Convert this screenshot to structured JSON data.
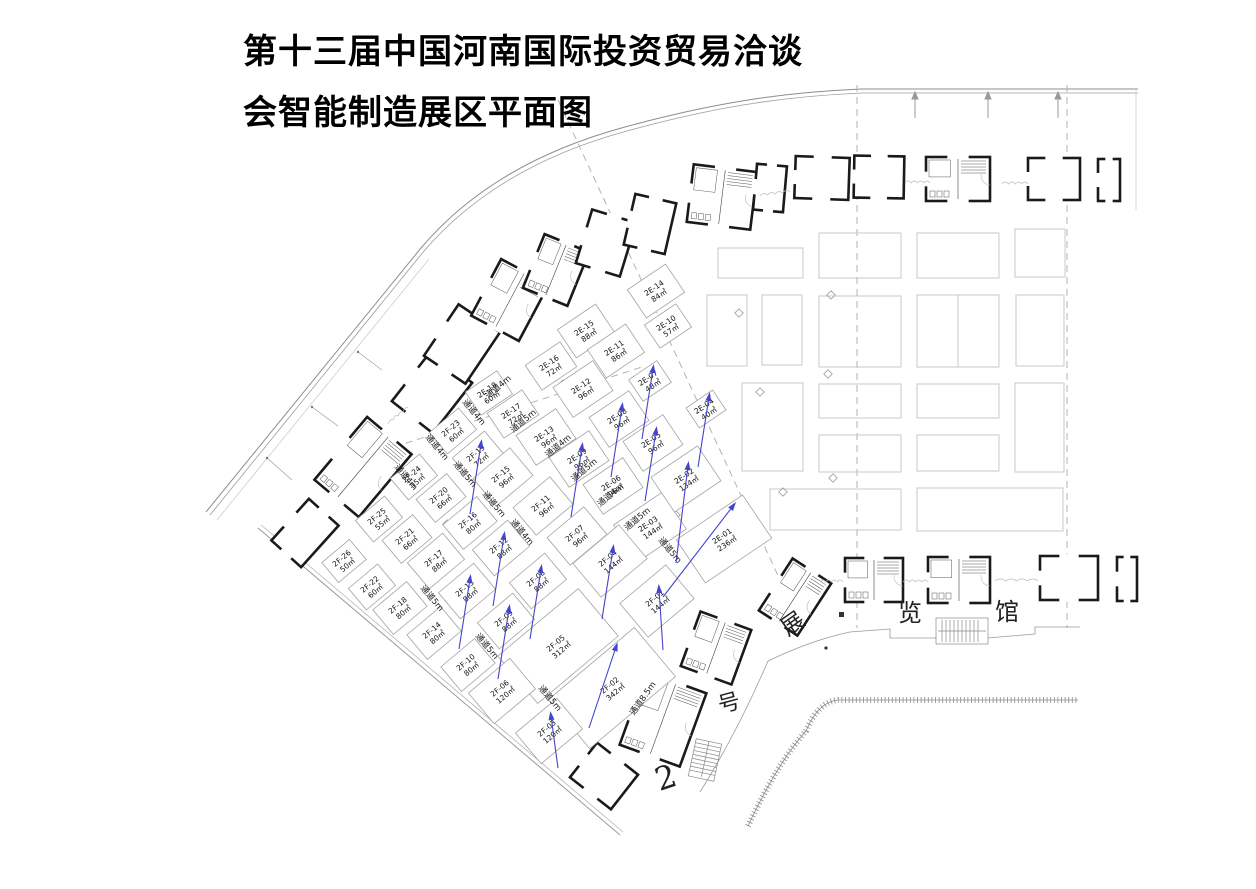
{
  "title": {
    "line1": "第十三届中国河南国际投资贸易洽谈",
    "line2": "会智能制造展区平面图"
  },
  "hall_text": [
    {
      "name": "hall-char-zhan",
      "ch": "展",
      "x": 797,
      "y": 630,
      "rot": -35,
      "size": 23
    },
    {
      "name": "hall-char-lan",
      "ch": "览",
      "x": 910,
      "y": 621,
      "rot": 0,
      "size": 24
    },
    {
      "name": "hall-char-guan",
      "ch": "馆",
      "x": 1007,
      "y": 620,
      "rot": 0,
      "size": 24
    },
    {
      "name": "hall-char-hao",
      "ch": "号",
      "x": 731,
      "y": 710,
      "rot": -15,
      "size": 22
    },
    {
      "name": "hall-number",
      "ch": "2",
      "x": 669,
      "y": 788,
      "rot": -18,
      "size": 32
    }
  ],
  "colors": {
    "arrow_blue": "#4444cc",
    "booth_outline": "#a3a3a3",
    "wall_black": "#1a1a1a",
    "gray_booth": "#c2c2c2",
    "dashed_line": "#b3b3b3"
  },
  "aisles": [
    {
      "label": "通道4m",
      "x": 500,
      "y": 389,
      "rot": -40
    },
    {
      "label": "通道5m",
      "x": 525,
      "y": 423,
      "rot": -40
    },
    {
      "label": "通道4m",
      "x": 560,
      "y": 448,
      "rot": -40
    },
    {
      "label": "通道5m",
      "x": 586,
      "y": 472,
      "rot": -40
    },
    {
      "label": "通道4m",
      "x": 612,
      "y": 497,
      "rot": -40
    },
    {
      "label": "通道5m",
      "x": 639,
      "y": 521,
      "rot": -40
    },
    {
      "label": "通道4m",
      "x": 472,
      "y": 414,
      "rot": 50
    },
    {
      "label": "通道4m",
      "x": 435,
      "y": 449,
      "rot": 50
    },
    {
      "label": "通道4m",
      "x": 404,
      "y": 479,
      "rot": 50
    },
    {
      "label": "通道5m",
      "x": 463,
      "y": 476,
      "rot": 50
    },
    {
      "label": "通道5m",
      "x": 492,
      "y": 506,
      "rot": 50
    },
    {
      "label": "通道4m",
      "x": 520,
      "y": 534,
      "rot": 50
    },
    {
      "label": "通道5m",
      "x": 430,
      "y": 600,
      "rot": 50
    },
    {
      "label": "通道5m",
      "x": 485,
      "y": 648,
      "rot": 50
    },
    {
      "label": "通道5m",
      "x": 548,
      "y": 700,
      "rot": 50
    },
    {
      "label": "通道5m",
      "x": 668,
      "y": 552,
      "rot": 50
    },
    {
      "label": "通道8.5m",
      "x": 645,
      "y": 700,
      "rot": -55
    }
  ],
  "booths": [
    {
      "id": "2E-18",
      "area": "60㎡",
      "cx": 489,
      "cy": 393,
      "w": 38,
      "h": 28,
      "rot": -34,
      "arrow": false
    },
    {
      "id": "2E-17",
      "area": "72㎡",
      "cx": 513,
      "cy": 414,
      "w": 42,
      "h": 30,
      "rot": -34,
      "arrow": false
    },
    {
      "id": "2E-16",
      "area": "72㎡",
      "cx": 551,
      "cy": 366,
      "w": 42,
      "h": 30,
      "rot": -34,
      "arrow": false
    },
    {
      "id": "2E-15",
      "area": "88㎡",
      "cx": 586,
      "cy": 331,
      "w": 46,
      "h": 34,
      "rot": -34,
      "arrow": false
    },
    {
      "id": "2E-14",
      "area": "84㎡",
      "cx": 656,
      "cy": 291,
      "w": 46,
      "h": 34,
      "rot": -34,
      "arrow": false
    },
    {
      "id": "2E-13",
      "area": "96㎡",
      "cx": 546,
      "cy": 437,
      "w": 48,
      "h": 36,
      "rot": -34,
      "arrow": false
    },
    {
      "id": "2E-12",
      "area": "96㎡",
      "cx": 583,
      "cy": 389,
      "w": 48,
      "h": 36,
      "rot": -34,
      "arrow": false
    },
    {
      "id": "2E-11",
      "area": "86㎡",
      "cx": 616,
      "cy": 351,
      "w": 46,
      "h": 34,
      "rot": -34,
      "arrow": false
    },
    {
      "id": "2E-10",
      "area": "57㎡",
      "cx": 668,
      "cy": 326,
      "w": 38,
      "h": 28,
      "rot": -34,
      "arrow": false
    },
    {
      "id": "2E-09",
      "area": "96㎡",
      "cx": 579,
      "cy": 459,
      "w": 48,
      "h": 36,
      "rot": -34,
      "arrow": true
    },
    {
      "id": "2E-08",
      "area": "96㎡",
      "cx": 619,
      "cy": 419,
      "w": 48,
      "h": 36,
      "rot": -34,
      "arrow": true
    },
    {
      "id": "2E-07",
      "area": "48㎡",
      "cx": 650,
      "cy": 381,
      "w": 34,
      "h": 26,
      "rot": -34,
      "arrow": true
    },
    {
      "id": "2E-06",
      "area": "96㎡",
      "cx": 613,
      "cy": 486,
      "w": 48,
      "h": 36,
      "rot": -34,
      "arrow": false
    },
    {
      "id": "2E-05",
      "area": "96㎡",
      "cx": 653,
      "cy": 443,
      "w": 48,
      "h": 36,
      "rot": -34,
      "arrow": true
    },
    {
      "id": "2E-04",
      "area": "40㎡",
      "cx": 706,
      "cy": 409,
      "w": 32,
      "h": 24,
      "rot": -34,
      "arrow": true
    },
    {
      "id": "2E-03",
      "area": "144㎡",
      "cx": 650,
      "cy": 527,
      "w": 58,
      "h": 44,
      "rot": -34,
      "arrow": false
    },
    {
      "id": "2E-02",
      "area": "134㎡",
      "cx": 686,
      "cy": 479,
      "w": 56,
      "h": 42,
      "rot": -34,
      "arrow": true,
      "a": [
        688,
        466,
        676,
        563
      ]
    },
    {
      "id": "2E-01",
      "area": "236㎡",
      "cx": 724,
      "cy": 539,
      "w": 80,
      "h": 52,
      "rot": -34,
      "arrow": true,
      "a": [
        733,
        506,
        663,
        597
      ]
    },
    {
      "id": "2F-23",
      "area": "60㎡",
      "cx": 453,
      "cy": 431,
      "w": 38,
      "h": 28,
      "rot": -40,
      "arrow": false
    },
    {
      "id": "2F-19",
      "area": "72㎡",
      "cx": 478,
      "cy": 456,
      "w": 42,
      "h": 30,
      "rot": -40,
      "arrow": true
    },
    {
      "id": "2F-15",
      "area": "96㎡",
      "cx": 503,
      "cy": 477,
      "w": 48,
      "h": 36,
      "rot": -40,
      "arrow": false
    },
    {
      "id": "2F-11",
      "area": "96㎡",
      "cx": 543,
      "cy": 506,
      "w": 48,
      "h": 36,
      "rot": -40,
      "arrow": false
    },
    {
      "id": "2F-07",
      "area": "96㎡",
      "cx": 577,
      "cy": 536,
      "w": 48,
      "h": 36,
      "rot": -40,
      "arrow": false
    },
    {
      "id": "2F-24",
      "area": "55㎡",
      "cx": 414,
      "cy": 477,
      "w": 38,
      "h": 28,
      "rot": -40,
      "arrow": false
    },
    {
      "id": "2F-20",
      "area": "66㎡",
      "cx": 441,
      "cy": 498,
      "w": 40,
      "h": 30,
      "rot": -40,
      "arrow": false
    },
    {
      "id": "2F-16",
      "area": "80㎡",
      "cx": 470,
      "cy": 523,
      "w": 44,
      "h": 32,
      "rot": -40,
      "arrow": false
    },
    {
      "id": "2F-12",
      "area": "88㎡",
      "cx": 501,
      "cy": 548,
      "w": 46,
      "h": 34,
      "rot": -40,
      "arrow": true
    },
    {
      "id": "2F-08",
      "area": "88㎡",
      "cx": 538,
      "cy": 581,
      "w": 46,
      "h": 34,
      "rot": -40,
      "arrow": true
    },
    {
      "id": "2F-04",
      "area": "144㎡",
      "cx": 610,
      "cy": 561,
      "w": 60,
      "h": 44,
      "rot": -40,
      "arrow": true
    },
    {
      "id": "2F-01",
      "area": "144㎡",
      "cx": 657,
      "cy": 601,
      "w": 60,
      "h": 44,
      "rot": -40,
      "arrow": true,
      "a": [
        659,
        589,
        663,
        650
      ]
    },
    {
      "id": "2F-25",
      "area": "55㎡",
      "cx": 379,
      "cy": 519,
      "w": 38,
      "h": 28,
      "rot": -40,
      "arrow": false
    },
    {
      "id": "2F-21",
      "area": "66㎡",
      "cx": 407,
      "cy": 539,
      "w": 40,
      "h": 30,
      "rot": -40,
      "arrow": false
    },
    {
      "id": "2F-17",
      "area": "88㎡",
      "cx": 436,
      "cy": 561,
      "w": 46,
      "h": 34,
      "rot": -40,
      "arrow": false
    },
    {
      "id": "2F-13",
      "area": "88㎡",
      "cx": 467,
      "cy": 591,
      "w": 46,
      "h": 34,
      "rot": -40,
      "arrow": true
    },
    {
      "id": "2F-09",
      "area": "88㎡",
      "cx": 506,
      "cy": 621,
      "w": 46,
      "h": 34,
      "rot": -40,
      "arrow": true
    },
    {
      "id": "2F-05",
      "area": "312㎡",
      "cx": 558,
      "cy": 646,
      "w": 105,
      "h": 62,
      "rot": -40,
      "arrow": false
    },
    {
      "id": "2F-02",
      "area": "342㎡",
      "cx": 612,
      "cy": 688,
      "w": 112,
      "h": 64,
      "rot": -40,
      "arrow": true,
      "a": [
        616,
        647,
        589,
        728
      ]
    },
    {
      "id": "2F-26",
      "area": "50㎡",
      "cx": 344,
      "cy": 561,
      "w": 36,
      "h": 26,
      "rot": -40,
      "arrow": false
    },
    {
      "id": "2F-22",
      "area": "60㎡",
      "cx": 372,
      "cy": 587,
      "w": 38,
      "h": 28,
      "rot": -40,
      "arrow": false
    },
    {
      "id": "2F-18",
      "area": "80㎡",
      "cx": 400,
      "cy": 608,
      "w": 44,
      "h": 32,
      "rot": -40,
      "arrow": false
    },
    {
      "id": "2F-14",
      "area": "80㎡",
      "cx": 434,
      "cy": 633,
      "w": 44,
      "h": 32,
      "rot": -40,
      "arrow": false
    },
    {
      "id": "2F-10",
      "area": "80㎡",
      "cx": 468,
      "cy": 665,
      "w": 44,
      "h": 32,
      "rot": -40,
      "arrow": false
    },
    {
      "id": "2F-06",
      "area": "120㎡",
      "cx": 502,
      "cy": 691,
      "w": 54,
      "h": 40,
      "rot": -40,
      "arrow": false
    },
    {
      "id": "2F-03",
      "area": "120㎡",
      "cx": 549,
      "cy": 731,
      "w": 54,
      "h": 40,
      "rot": -40,
      "arrow": true,
      "a": [
        551,
        716,
        558,
        768
      ]
    }
  ]
}
